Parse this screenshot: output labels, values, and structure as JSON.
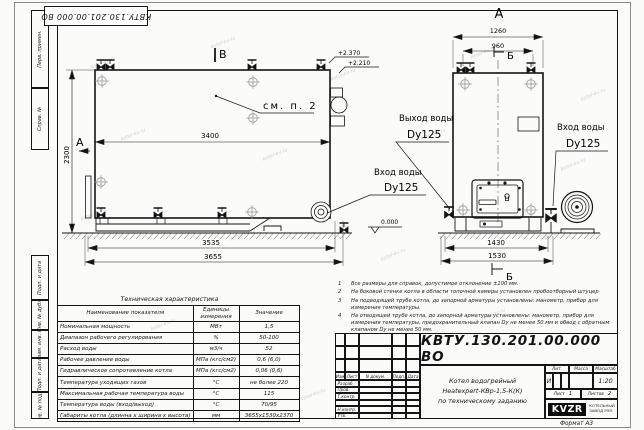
{
  "watermark": {
    "text": "kotel-kv.ru"
  },
  "stamp_top": {
    "doc_number": "КВТУ.130.201.00.000 ВО"
  },
  "side_strip": {
    "labels": [
      "Перв. примен.",
      "Справ. №",
      "Подп. и дата",
      "Инв. № дубл.",
      "Взам. инв. №",
      "Подп. и дата",
      "Инв. № подл."
    ]
  },
  "labels": {
    "view_b": "В",
    "view_a": "А",
    "front_view": "А",
    "section_b_top": "Б",
    "section_b_bottom": "Б",
    "see_note": "см. п. 2",
    "outlet_title": "Выход воды",
    "outlet_dn": "Dy125",
    "inlet_title": "Вход воды",
    "inlet_dn": "Dy125",
    "inlet2_title": "Вход воды",
    "inlet2_dn": "Dy125",
    "elev_top1": "+2.370",
    "elev_top2": "+2.210",
    "elev_zero": "0.000"
  },
  "dims": {
    "side_len": "3400",
    "side_h": "2300",
    "base_len1": "3535",
    "base_len2": "3655",
    "front_w1": "1260",
    "front_w2": "960",
    "front_base1": "1430",
    "front_base2": "1530"
  },
  "notes": [
    {
      "num": "1",
      "text": "Все размеры для справок, допустимое отклонение ±100 мм."
    },
    {
      "num": "2",
      "text": "На боковой стенке котла в области топочной камеры установлен пробоотборный штуцер"
    },
    {
      "num": "3",
      "text": "На подводящей трубе котла, до запорной арматуры установлены: манометр, прибор для измерения температуры."
    },
    {
      "num": "4",
      "text": "На отводящей трубе котла, до запорной арматуры установлены: манометр, прибор для измерения температуры, предохранительный клапан Dу не менее 50 мм и обвод с обратным клапаном Dу не менее 50 мм."
    }
  ],
  "spec_table": {
    "title": "Техническая характеристика",
    "col_name": "Наименование показателя",
    "col_units": "Единицы измерения",
    "col_value": "Значение",
    "rows": [
      {
        "name": "Номинальная мощность",
        "units": "МВт",
        "value": "1,5"
      },
      {
        "name": "Диапазон рабочего регулирования",
        "units": "%",
        "value": "50-100"
      },
      {
        "name": "Расход воды",
        "units": "м3/ч",
        "value": "52"
      },
      {
        "name": "Рабочее давление воды",
        "units": "МПа (кгс/см2)",
        "value": "0,6 (6,0)"
      },
      {
        "name": "Гидравлическое сопротивление котла",
        "units": "МПа (кгс/см2)",
        "value": "0,06 (0,6)"
      },
      {
        "name": "Температура уходящих газов",
        "units": "°С",
        "value": "не более 220"
      },
      {
        "name": "Максимальная рабочая температура воды",
        "units": "°С",
        "value": "115"
      },
      {
        "name": "Температура воды (вход/выход)",
        "units": "°С",
        "value": "70/95"
      },
      {
        "name": "Габариты котла (длинна х ширина х высота)",
        "units": "мм",
        "value": "3655х1530х2370"
      }
    ]
  },
  "title_block": {
    "doc_number": "КВТУ.130.201.00.000  ВО",
    "product_line1": "Котел водогрейный",
    "product_line2": "Heatexpert-КВр-1,5-К(К)",
    "product_line3": "по техническому заданию",
    "col_izm": "Изм",
    "col_list": "Лист",
    "col_doc": "N докум.",
    "col_podp": "Подп.",
    "col_data": "Дата",
    "row_razrab": "Разраб.",
    "row_prov": "Пров.",
    "row_tkontr": "Т.контр.",
    "row_nkontr": "Н.контр.",
    "row_utv": "Утв.",
    "lit_label": "Лит.",
    "mass_label": "Масса",
    "scale_label": "Масштаб",
    "lit_value": "И",
    "scale_value": "1:20",
    "sheet_label": "Лист",
    "sheet_value": "1",
    "sheets_label": "Листов",
    "sheets_value": "2",
    "logo": "KVZR",
    "logo_sub1": "КОТЕЛЬНЫЙ",
    "logo_sub2": "ЗАВОД РЭП",
    "format": "Формат  А3"
  }
}
